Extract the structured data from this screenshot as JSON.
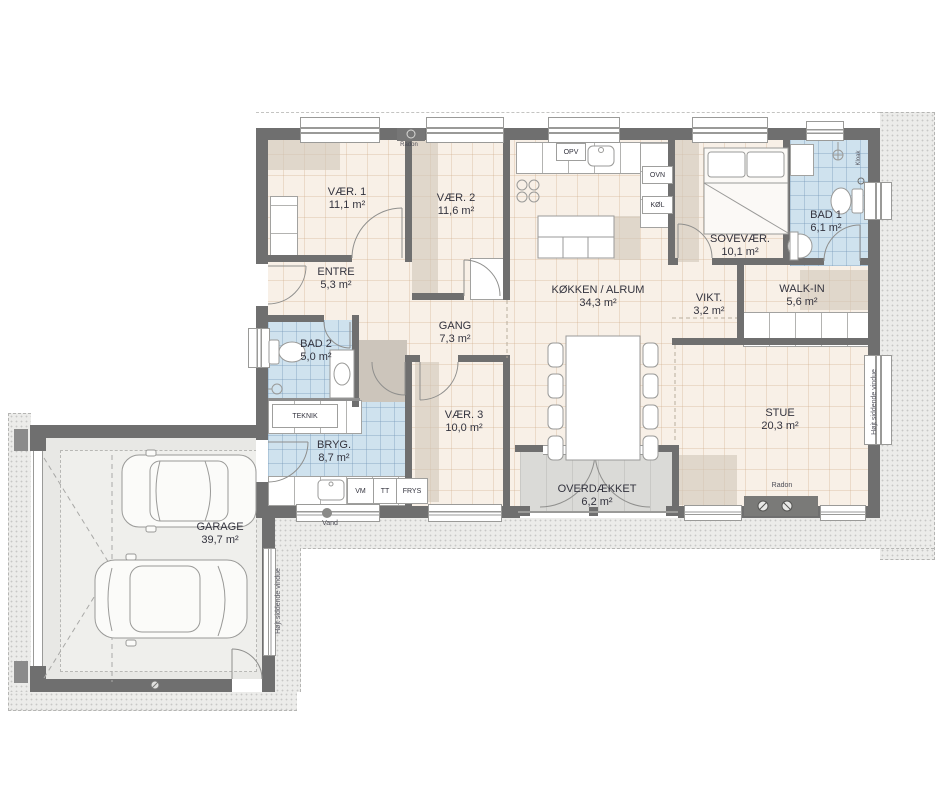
{
  "plan": {
    "rooms": [
      {
        "name": "VÆR. 1",
        "area": "11,1 m²"
      },
      {
        "name": "VÆR. 2",
        "area": "11,6 m²"
      },
      {
        "name": "ENTRE",
        "area": "5,3 m²"
      },
      {
        "name": "KØKKEN / ALRUM",
        "area": "34,3 m²"
      },
      {
        "name": "SOVEVÆR.",
        "area": "10,1 m²"
      },
      {
        "name": "BAD 1",
        "area": "6,1 m²"
      },
      {
        "name": "VIKT.",
        "area": "3,2 m²"
      },
      {
        "name": "WALK-IN",
        "area": "5,6 m²"
      },
      {
        "name": "GANG",
        "area": "7,3 m²"
      },
      {
        "name": "BAD 2",
        "area": "5,0 m²"
      },
      {
        "name": "BRYG.",
        "area": "8,7 m²"
      },
      {
        "name": "TEKNIK",
        "area": ""
      },
      {
        "name": "VÆR. 3",
        "area": "10,0 m²"
      },
      {
        "name": "STUE",
        "area": "20,3 m²"
      },
      {
        "name": "OVERDÆKKET",
        "area": "6,2 m²"
      },
      {
        "name": "GARAGE",
        "area": "39,7 m²"
      }
    ],
    "appliances": {
      "opv": "OPV",
      "ovn": "OVN",
      "koel": "KØL",
      "vm": "VM",
      "tt": "TT",
      "frys": "FRYS"
    },
    "annotations": {
      "radon": "Radon",
      "vand": "Vand",
      "kloak": "Kloak",
      "high_window": "Højt siddende vindue"
    },
    "colors": {
      "wall": "#6f6f6f",
      "floor": "#f8f0e7",
      "wet_room": "#cfe2ee",
      "garage_floor": "#e8e8e5",
      "terrace": "#dadad7",
      "eaves": "#ececea",
      "text": "#33333e"
    }
  }
}
